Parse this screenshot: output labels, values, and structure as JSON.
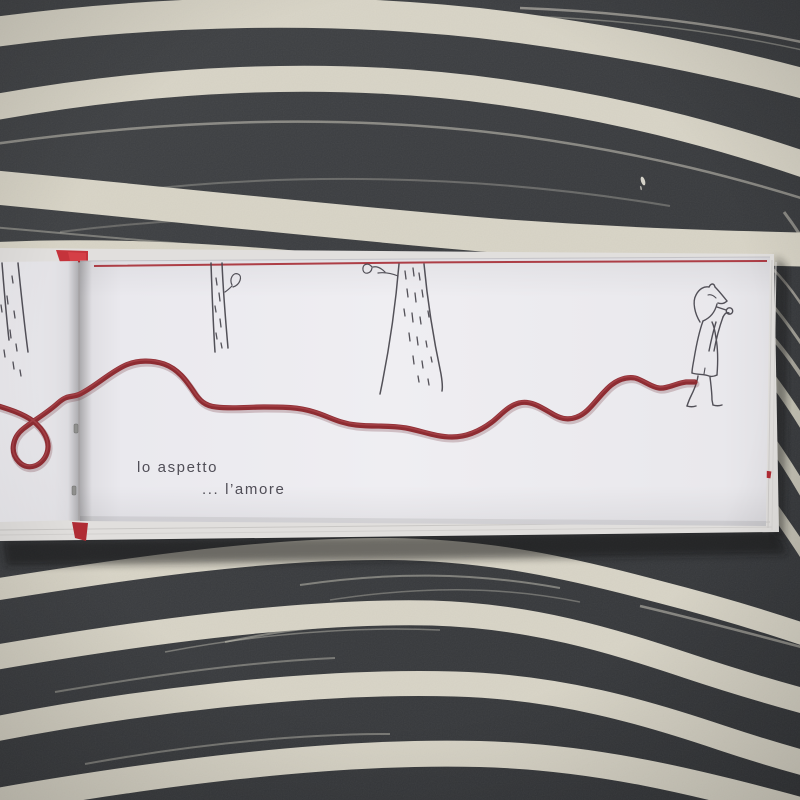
{
  "scene": {
    "type": "photograph of an open picture book lying on a black-and-white brush-striped cloth",
    "captions": {
      "line1": "lo aspetto",
      "line2": "... l’amore"
    },
    "drawings": {
      "left_page_tree": "partial inked tree trunk",
      "small_tree": "thin tree trunk with one leaf",
      "large_tree": "wide tree trunk with twig and leaf",
      "character": "fox-like figure in a tunic smoking a pipe",
      "thread": "red yarn winding across both pages ending at the figure's feet"
    },
    "colors": {
      "backdrop_dark": "#3a3c3f",
      "stripe_cream": "#d8d4c6",
      "page_white": "#ecebef",
      "thread_red": "#8e2c32",
      "cover_red": "#bf2d35",
      "ink": "#46444c",
      "caption_ink": "#504e57"
    }
  }
}
